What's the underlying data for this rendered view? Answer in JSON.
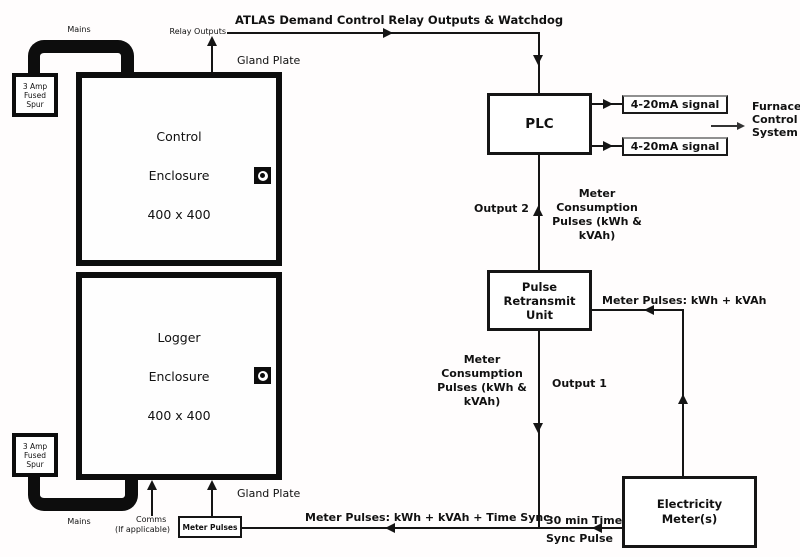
{
  "colors": {
    "ink": "#111111",
    "background": "#ffffff"
  },
  "title": "ATLAS Demand Control Relay Outputs & Watchdog",
  "labels": {
    "mains_top": "Mains",
    "mains_bottom": "Mains",
    "relay_outputs": "Relay Outputs",
    "gland_plate_top": "Gland Plate",
    "gland_plate_bottom": "Gland Plate",
    "output_2": "Output 2",
    "output_1": "Output 1",
    "meter_pulses_right": "Meter Pulses: kWh + kVAh",
    "meter_pulses_bottom": "Meter Pulses: kWh + kVAh + Time Sync",
    "time_sync": [
      "30 min Time",
      "Sync Pulse"
    ],
    "comms": [
      "Comms",
      "(If applicable)"
    ],
    "furnace": [
      "Furnace",
      "Control",
      "System"
    ],
    "meter_consumption_upper": [
      "Meter",
      "Consumption",
      "Pulses (kWh &",
      "kVAh)"
    ],
    "meter_consumption_lower": [
      "Meter",
      "Consumption",
      "Pulses (kWh &",
      "kVAh)"
    ]
  },
  "nodes": {
    "plc": {
      "label": "PLC"
    },
    "signal_top": {
      "label": "4-20mA signal"
    },
    "signal_bottom": {
      "label": "4-20mA signal"
    },
    "pulse_retransmit_unit": {
      "lines": [
        "Pulse",
        "Retransmit",
        "Unit"
      ]
    },
    "electricity_meters": {
      "lines": [
        "Electricity",
        "Meter(s)"
      ]
    },
    "control_enclosure": {
      "lines": [
        "Control",
        "Enclosure",
        "400 x 400"
      ]
    },
    "logger_enclosure": {
      "lines": [
        "Logger",
        "Enclosure",
        "400 x 400"
      ]
    },
    "fused_spur_top": {
      "lines": [
        "3 Amp",
        "Fused",
        "Spur"
      ]
    },
    "fused_spur_bottom": {
      "lines": [
        "3 Amp",
        "Fused",
        "Spur"
      ]
    },
    "meter_pulses_box": {
      "label": "Meter Pulses"
    }
  }
}
